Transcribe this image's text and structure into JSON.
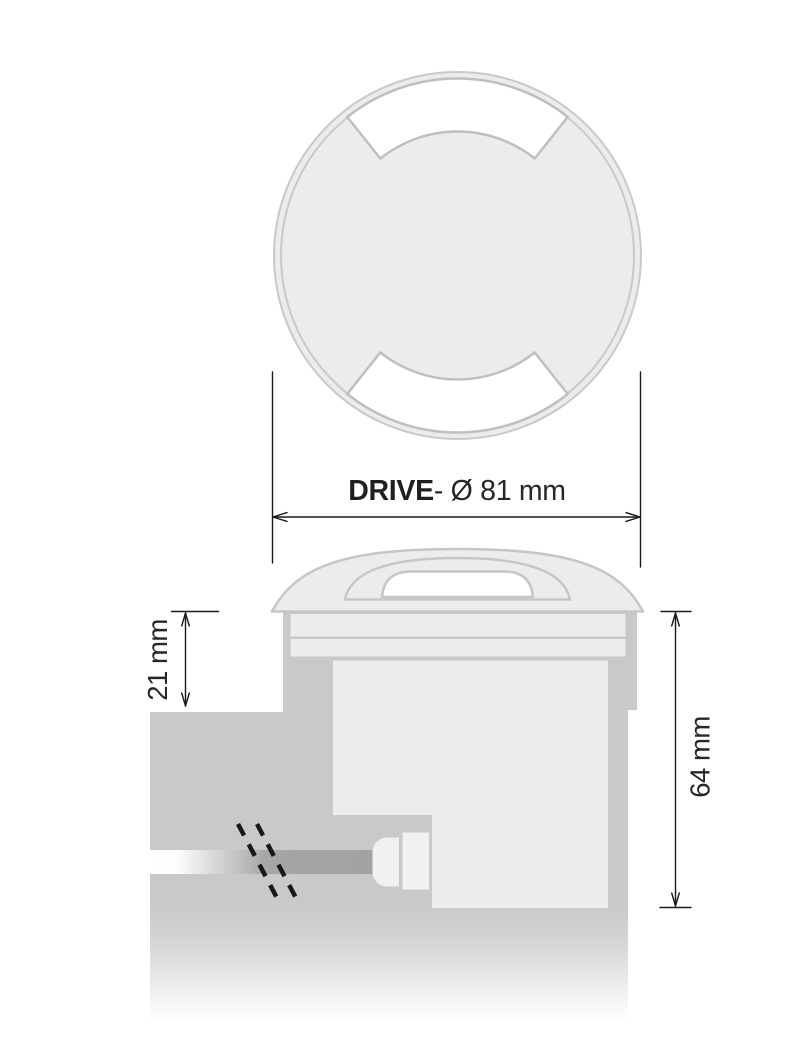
{
  "product": {
    "name": "DRIVE"
  },
  "labels": {
    "diameter_bold": "DRIVE",
    "diameter_rest": "- Ø 81 mm",
    "height_21": "21 mm",
    "height_64": "64 mm"
  },
  "dimensions_mm": {
    "diameter": 81,
    "top_above_ground_height": 21,
    "total_height": 64
  },
  "views": {
    "top_view": "round cover with two opposite light-exit windows",
    "side_view": "recessed installation cross-section with cable gland"
  },
  "colors": {
    "background": "#ffffff",
    "fixture_fill": "#ececec",
    "fixture_outline": "#c6c6c6",
    "ring_outline": "#c9c9c9",
    "window_outline": "#bfbfbf",
    "window_fill": "#ffffff",
    "ground_fill": "#c9c9c9",
    "cable_gray": "#a6a6a6",
    "gland_fill": "#f1f1f1",
    "break_mark": "#17171b",
    "dimension_line": "#1a1a1a",
    "label_text": "#24272b"
  }
}
